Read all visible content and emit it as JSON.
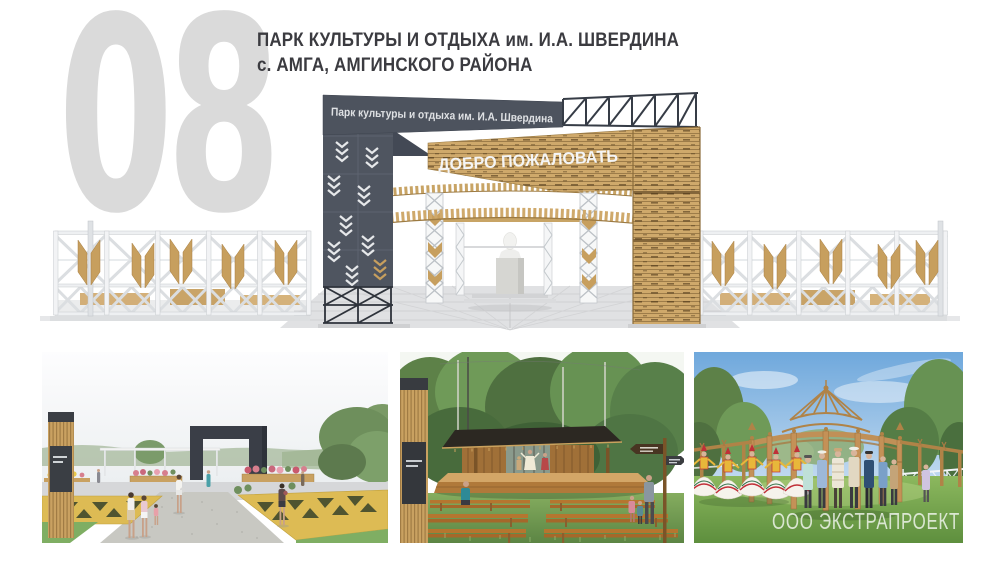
{
  "slide": {
    "number": "08",
    "title_line1": "ПАРК КУЛЬТУРЫ И ОТДЫХА им. И.А. ШВЕРДИНА",
    "title_line2": "с. АМГА, АМГИНСКОГО РАЙОНА"
  },
  "main_render": {
    "gate_sign": "Парк культуры и отдыха им. И.А. Швердина",
    "welcome_sign": "ДОБРО ПОЖАЛОВАТЬ"
  },
  "gallery": {
    "watermark": "ООО ЭКСТРАПРОЕКТ"
  },
  "colors": {
    "slide_number": "#dadada",
    "title_text": "#3b3b40",
    "dark_panel": "#4f5560",
    "steel_truss": "#363c46",
    "wood_light": "#cfa96b",
    "wood_dark": "#8a6b3a",
    "fence_white": "#eef0f2",
    "ornament_yellow": "#ddbb54",
    "grass_green": "#7fae63",
    "sky_blue": "#6fa8dc"
  }
}
